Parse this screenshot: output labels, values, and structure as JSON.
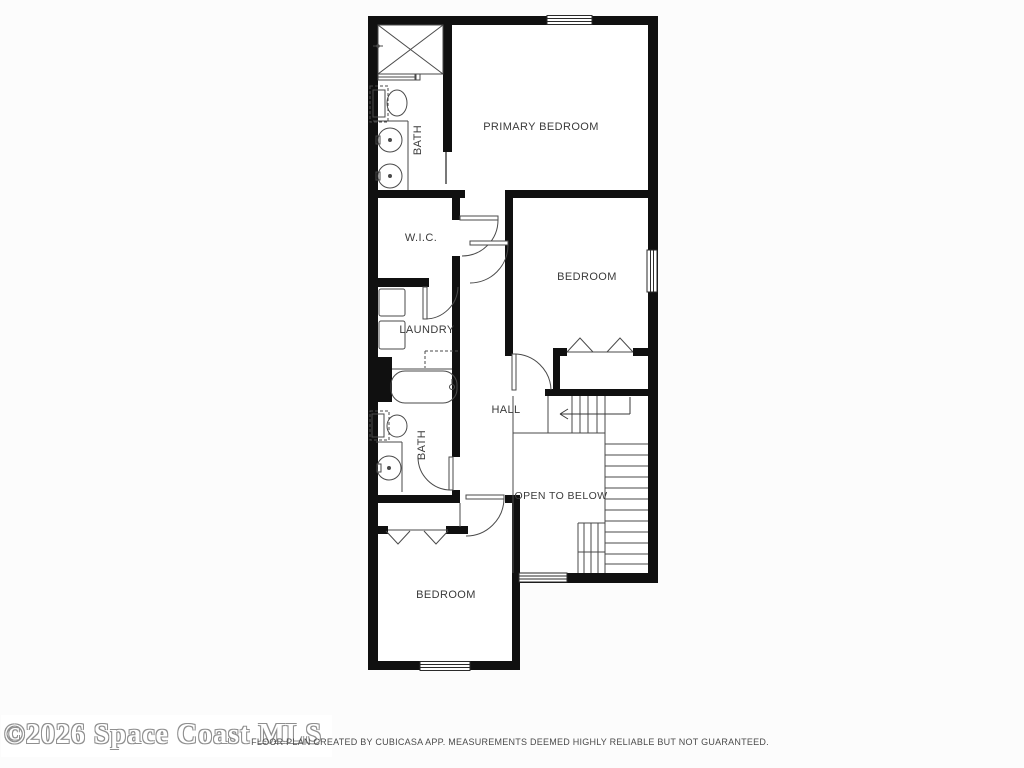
{
  "meta": {
    "type": "floor-plan",
    "creator_app": "CubiCasa"
  },
  "watermark": {
    "text": "©2026 Space Coast MLS"
  },
  "footer": {
    "disclaimer": "FLOOR PLAN CREATED BY CUBICASA APP. MEASUREMENTS DEEMED HIGHLY RELIABLE BUT NOT GUARANTEED."
  },
  "plan": {
    "colors": {
      "wall": "#101010",
      "line": "#4a4a4a",
      "label": "#3a3a3a",
      "floor": "#ffffff",
      "background": "#fcfcfc"
    },
    "labels": [
      {
        "id": "primary-bedroom",
        "text": "PRIMARY BEDROOM"
      },
      {
        "id": "bath-primary",
        "text": "BATH"
      },
      {
        "id": "wic",
        "text": "W.I.C."
      },
      {
        "id": "laundry",
        "text": "LAUNDRY"
      },
      {
        "id": "bedroom-middle",
        "text": "BEDROOM"
      },
      {
        "id": "hall",
        "text": "HALL"
      },
      {
        "id": "bath-hall",
        "text": "BATH"
      },
      {
        "id": "open-to-below",
        "text": "OPEN TO BELOW"
      },
      {
        "id": "bedroom-bottom",
        "text": "BEDROOM"
      }
    ]
  }
}
